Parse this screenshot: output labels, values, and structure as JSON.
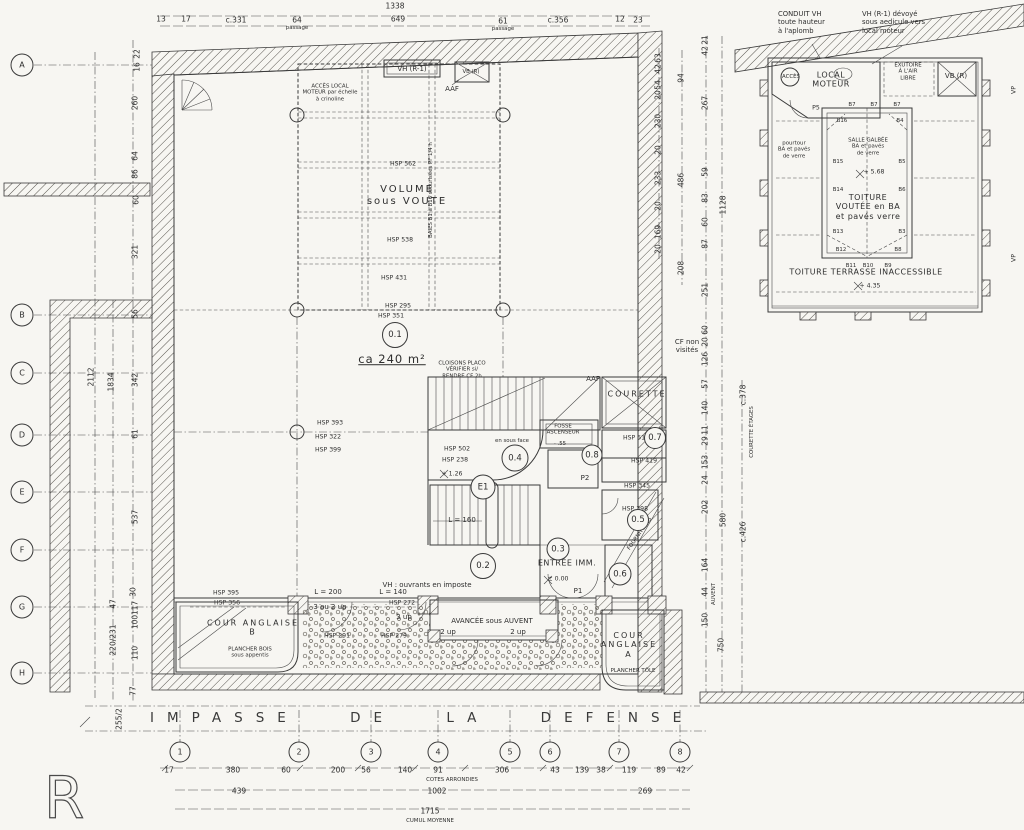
{
  "level_mark": "R",
  "street": {
    "name": "IMPASSE DE LA DEFENSE"
  },
  "grid_rows": [
    {
      "t": "A",
      "y": 65
    },
    {
      "t": "B",
      "y": 315
    },
    {
      "t": "C",
      "y": 373
    },
    {
      "t": "D",
      "y": 435
    },
    {
      "t": "E",
      "y": 492
    },
    {
      "t": "F",
      "y": 550
    },
    {
      "t": "G",
      "y": 607
    },
    {
      "t": "H",
      "y": 673
    }
  ],
  "grid_cols": [
    {
      "t": "1",
      "x": 180
    },
    {
      "t": "2",
      "x": 299
    },
    {
      "t": "3",
      "x": 371
    },
    {
      "t": "4",
      "x": 438
    },
    {
      "t": "5",
      "x": 510
    },
    {
      "t": "6",
      "x": 550
    },
    {
      "t": "7",
      "x": 619
    },
    {
      "t": "8",
      "x": 680
    }
  ],
  "rooms": [
    {
      "t": "0.1",
      "x": 395,
      "y": 335,
      "d": 24
    },
    {
      "t": "0.2",
      "x": 483,
      "y": 566,
      "d": 24
    },
    {
      "t": "0.3",
      "x": 558,
      "y": 549,
      "d": 21
    },
    {
      "t": "0.4",
      "x": 515,
      "y": 458,
      "d": 25
    },
    {
      "t": "0.5",
      "x": 638,
      "y": 520,
      "d": 20
    },
    {
      "t": "0.6",
      "x": 620,
      "y": 574,
      "d": 21
    },
    {
      "t": "0.7",
      "x": 655,
      "y": 438,
      "d": 20
    },
    {
      "t": "0.8",
      "x": 592,
      "y": 455,
      "d": 19
    },
    {
      "t": "E1",
      "x": 483,
      "y": 487,
      "d": 23
    }
  ],
  "annotations": [
    {
      "t": "CONDUIT VH\ntoute hauteur\nà l'aplomb",
      "x": 778,
      "y": 10,
      "c": "note",
      "n": "note-conduit-vh"
    },
    {
      "t": "VH (R-1) dévoyé\nsous aedicule vers\nlocal moteur",
      "x": 862,
      "y": 10,
      "c": "note",
      "n": "note-vh-devoye"
    },
    {
      "t": "1338",
      "x": 395,
      "y": 7,
      "c": "dim"
    },
    {
      "t": "13",
      "x": 161,
      "y": 20,
      "c": "dim"
    },
    {
      "t": "17",
      "x": 186,
      "y": 20,
      "c": "dim"
    },
    {
      "t": "c.331",
      "x": 236,
      "y": 21,
      "c": "dim"
    },
    {
      "t": "64",
      "x": 297,
      "y": 21,
      "c": "dim"
    },
    {
      "t": "passage",
      "x": 297,
      "y": 28,
      "c": "micro"
    },
    {
      "t": "649",
      "x": 398,
      "y": 20,
      "c": "dim"
    },
    {
      "t": "61",
      "x": 503,
      "y": 22,
      "c": "dim"
    },
    {
      "t": "passage",
      "x": 503,
      "y": 29,
      "c": "micro"
    },
    {
      "t": "c.356",
      "x": 558,
      "y": 21,
      "c": "dim"
    },
    {
      "t": "12",
      "x": 620,
      "y": 20,
      "c": "dim"
    },
    {
      "t": "23",
      "x": 638,
      "y": 21,
      "c": "dim"
    },
    {
      "t": "22",
      "x": 138,
      "y": 54,
      "r": -90,
      "c": "dim"
    },
    {
      "t": "16",
      "x": 138,
      "y": 67,
      "r": -90,
      "c": "dim"
    },
    {
      "t": "260",
      "x": 136,
      "y": 103,
      "r": -90,
      "c": "dim"
    },
    {
      "t": "64",
      "x": 136,
      "y": 156,
      "r": -90,
      "c": "dim"
    },
    {
      "t": "86",
      "x": 136,
      "y": 174,
      "r": -90,
      "c": "dim"
    },
    {
      "t": "60",
      "x": 137,
      "y": 200,
      "r": -90,
      "c": "dim"
    },
    {
      "t": "321",
      "x": 136,
      "y": 252,
      "r": -90,
      "c": "dim"
    },
    {
      "t": "56",
      "x": 136,
      "y": 314,
      "r": -90,
      "c": "dim"
    },
    {
      "t": "2112",
      "x": 92,
      "y": 377,
      "r": -90,
      "c": "dim"
    },
    {
      "t": "1834",
      "x": 112,
      "y": 382,
      "r": -90,
      "c": "dim"
    },
    {
      "t": "342",
      "x": 136,
      "y": 380,
      "r": -90,
      "c": "dim"
    },
    {
      "t": "61",
      "x": 136,
      "y": 434,
      "r": -90,
      "c": "dim"
    },
    {
      "t": "537",
      "x": 136,
      "y": 517,
      "r": -90,
      "c": "dim"
    },
    {
      "t": "30",
      "x": 134,
      "y": 592,
      "r": -90,
      "c": "dim"
    },
    {
      "t": "47",
      "x": 114,
      "y": 604,
      "r": -90,
      "c": "dim"
    },
    {
      "t": "117",
      "x": 136,
      "y": 608,
      "r": -90,
      "c": "dim"
    },
    {
      "t": "100",
      "x": 136,
      "y": 622,
      "r": -90,
      "c": "dim"
    },
    {
      "t": "220/231",
      "x": 114,
      "y": 640,
      "r": -90,
      "c": "dim"
    },
    {
      "t": "110",
      "x": 136,
      "y": 653,
      "r": -90,
      "c": "dim"
    },
    {
      "t": "77",
      "x": 134,
      "y": 691,
      "r": -90,
      "c": "dim"
    },
    {
      "t": "255/2",
      "x": 120,
      "y": 719,
      "r": -90,
      "c": "dim"
    },
    {
      "t": "63",
      "x": 659,
      "y": 58,
      "r": -90,
      "c": "dim"
    },
    {
      "t": "42",
      "x": 659,
      "y": 69,
      "r": -90,
      "c": "dim"
    },
    {
      "t": "54",
      "x": 659,
      "y": 85,
      "r": -90,
      "c": "dim"
    },
    {
      "t": "20",
      "x": 659,
      "y": 95,
      "r": -90,
      "c": "dim"
    },
    {
      "t": "230",
      "x": 659,
      "y": 121,
      "r": -90,
      "c": "dim"
    },
    {
      "t": "20",
      "x": 659,
      "y": 150,
      "r": -90,
      "c": "dim"
    },
    {
      "t": "233",
      "x": 659,
      "y": 178,
      "r": -90,
      "c": "dim"
    },
    {
      "t": "20",
      "x": 659,
      "y": 206,
      "r": -90,
      "c": "dim"
    },
    {
      "t": "169",
      "x": 659,
      "y": 232,
      "r": -90,
      "c": "dim"
    },
    {
      "t": "20",
      "x": 659,
      "y": 249,
      "r": -90,
      "c": "dim"
    },
    {
      "t": "94",
      "x": 682,
      "y": 78,
      "r": -90,
      "c": "dim"
    },
    {
      "t": "486",
      "x": 682,
      "y": 180,
      "r": -90,
      "c": "dim"
    },
    {
      "t": "208",
      "x": 682,
      "y": 268,
      "r": -90,
      "c": "dim"
    },
    {
      "t": "21",
      "x": 706,
      "y": 40,
      "r": -90,
      "c": "dim"
    },
    {
      "t": "42",
      "x": 706,
      "y": 51,
      "r": -90,
      "c": "dim"
    },
    {
      "t": "267",
      "x": 706,
      "y": 103,
      "r": -90,
      "c": "dim"
    },
    {
      "t": "59",
      "x": 706,
      "y": 172,
      "r": -90,
      "c": "dim"
    },
    {
      "t": "83",
      "x": 706,
      "y": 198,
      "r": -90,
      "c": "dim"
    },
    {
      "t": "60",
      "x": 706,
      "y": 222,
      "r": -90,
      "c": "dim"
    },
    {
      "t": "87",
      "x": 706,
      "y": 244,
      "r": -90,
      "c": "dim"
    },
    {
      "t": "251",
      "x": 706,
      "y": 290,
      "r": -90,
      "c": "dim"
    },
    {
      "t": "60",
      "x": 706,
      "y": 330,
      "r": -90,
      "c": "dim"
    },
    {
      "t": "20",
      "x": 706,
      "y": 342,
      "r": -90,
      "c": "dim"
    },
    {
      "t": "126",
      "x": 706,
      "y": 359,
      "r": -90,
      "c": "dim"
    },
    {
      "t": "57",
      "x": 706,
      "y": 384,
      "r": -90,
      "c": "dim"
    },
    {
      "t": "140",
      "x": 706,
      "y": 408,
      "r": -90,
      "c": "dim"
    },
    {
      "t": "11",
      "x": 706,
      "y": 430,
      "r": -90,
      "c": "dim"
    },
    {
      "t": "29",
      "x": 706,
      "y": 441,
      "r": -90,
      "c": "dim"
    },
    {
      "t": "153",
      "x": 706,
      "y": 462,
      "r": -90,
      "c": "dim"
    },
    {
      "t": "24",
      "x": 706,
      "y": 480,
      "r": -90,
      "c": "dim"
    },
    {
      "t": "202",
      "x": 706,
      "y": 507,
      "r": -90,
      "c": "dim"
    },
    {
      "t": "164",
      "x": 706,
      "y": 565,
      "r": -90,
      "c": "dim"
    },
    {
      "t": "44",
      "x": 706,
      "y": 592,
      "r": -90,
      "c": "dim"
    },
    {
      "t": "AUVENT",
      "x": 714,
      "y": 594,
      "r": -90,
      "c": "micro"
    },
    {
      "t": "150",
      "x": 706,
      "y": 620,
      "r": -90,
      "c": "dim"
    },
    {
      "t": "1128",
      "x": 724,
      "y": 205,
      "r": -90,
      "c": "dim"
    },
    {
      "t": "580",
      "x": 724,
      "y": 520,
      "r": -90,
      "c": "dim"
    },
    {
      "t": "c.378",
      "x": 744,
      "y": 395,
      "r": -90,
      "c": "dim"
    },
    {
      "t": "COURETTE ÉTAGES",
      "x": 752,
      "y": 432,
      "r": -90,
      "c": "micro"
    },
    {
      "t": "c.426",
      "x": 744,
      "y": 532,
      "r": -90,
      "c": "dim"
    },
    {
      "t": "750",
      "x": 722,
      "y": 645,
      "r": -90,
      "c": "dim"
    },
    {
      "t": "VP",
      "x": 1014,
      "y": 90,
      "r": -90,
      "c": "tiny"
    },
    {
      "t": "VP",
      "x": 1014,
      "y": 258,
      "r": -90,
      "c": "tiny"
    },
    {
      "t": "ACCÈS",
      "x": 791,
      "y": 77,
      "c": "micro"
    },
    {
      "t": "LOCAL\nMOTEUR",
      "x": 831,
      "y": 80,
      "c": "med"
    },
    {
      "t": "EXUTOIRE\nÀ L'AIR\nLIBRE",
      "x": 908,
      "y": 72,
      "c": "micro"
    },
    {
      "t": "VB (R)",
      "x": 956,
      "y": 76,
      "c": "small"
    },
    {
      "t": "P5",
      "x": 816,
      "y": 108,
      "c": "tiny"
    },
    {
      "t": "B7",
      "x": 852,
      "y": 105,
      "c": "micro"
    },
    {
      "t": "B7",
      "x": 874,
      "y": 105,
      "c": "micro"
    },
    {
      "t": "B7",
      "x": 897,
      "y": 105,
      "c": "micro"
    },
    {
      "t": "B16",
      "x": 842,
      "y": 121,
      "c": "micro"
    },
    {
      "t": "B4",
      "x": 900,
      "y": 121,
      "c": "micro"
    },
    {
      "t": "pourtour\nBA et pavés\nde verre",
      "x": 794,
      "y": 150,
      "c": "micro"
    },
    {
      "t": "SALLE GALBÉE\nBA et pavés\nde verre",
      "x": 868,
      "y": 147,
      "c": "micro"
    },
    {
      "t": "B15",
      "x": 838,
      "y": 162,
      "c": "micro"
    },
    {
      "t": "B5",
      "x": 902,
      "y": 162,
      "c": "micro"
    },
    {
      "t": "+ 5.68",
      "x": 874,
      "y": 172,
      "c": "tiny"
    },
    {
      "t": "B14",
      "x": 838,
      "y": 190,
      "c": "micro"
    },
    {
      "t": "B6",
      "x": 902,
      "y": 190,
      "c": "micro"
    },
    {
      "t": "TOITURE\nVOUTÉE en BA\net pavés verre",
      "x": 868,
      "y": 207,
      "c": "med"
    },
    {
      "t": "B13",
      "x": 838,
      "y": 232,
      "c": "micro"
    },
    {
      "t": "B3",
      "x": 902,
      "y": 232,
      "c": "micro"
    },
    {
      "t": "B12",
      "x": 841,
      "y": 250,
      "c": "micro"
    },
    {
      "t": "B8",
      "x": 898,
      "y": 250,
      "c": "micro"
    },
    {
      "t": "B11",
      "x": 851,
      "y": 266,
      "c": "micro"
    },
    {
      "t": "B10",
      "x": 868,
      "y": 266,
      "c": "micro"
    },
    {
      "t": "B9",
      "x": 888,
      "y": 266,
      "c": "micro"
    },
    {
      "t": "TOITURE  TERRASSE  INACCESSIBLE",
      "x": 866,
      "y": 272,
      "c": "med"
    },
    {
      "t": "+ 4.35",
      "x": 870,
      "y": 286,
      "c": "tiny"
    },
    {
      "t": "VH (R-1)",
      "x": 412,
      "y": 69,
      "c": "small"
    },
    {
      "t": "VB (R)",
      "x": 471,
      "y": 72,
      "c": "micro"
    },
    {
      "t": "AAF",
      "x": 452,
      "y": 89,
      "c": "small"
    },
    {
      "t": "ACCÈS LOCAL\nMOTEUR par échelle\nà crinoline",
      "x": 330,
      "y": 93,
      "c": "micro"
    },
    {
      "t": "HSP 562",
      "x": 403,
      "y": 164,
      "c": "tiny"
    },
    {
      "t": "VOLUME\nsous VOUTE",
      "x": 407,
      "y": 196,
      "c": "big"
    },
    {
      "t": "BAIES B1 à B16 sécurisées PF 1/4 h",
      "x": 431,
      "y": 190,
      "r": -90,
      "c": "micro"
    },
    {
      "t": "HSP 538",
      "x": 400,
      "y": 240,
      "c": "tiny"
    },
    {
      "t": "HSP 431",
      "x": 394,
      "y": 278,
      "c": "tiny"
    },
    {
      "t": "HSP 295",
      "x": 398,
      "y": 306,
      "c": "tiny"
    },
    {
      "t": "HSP 351",
      "x": 391,
      "y": 316,
      "c": "tiny"
    },
    {
      "t": "ca 240 m²",
      "x": 392,
      "y": 360,
      "c": "area",
      "n": "area-label"
    },
    {
      "t": "CLOISONS PLACO\nVÉRIFIER si/\nRENDRE CF 2h",
      "x": 462,
      "y": 370,
      "c": "micro"
    },
    {
      "t": "AAF",
      "x": 593,
      "y": 379,
      "c": "small"
    },
    {
      "t": "COURETTE",
      "x": 637,
      "y": 394,
      "c": "med ls2"
    },
    {
      "t": "HSP 393",
      "x": 330,
      "y": 423,
      "c": "tiny"
    },
    {
      "t": "HSP 322",
      "x": 328,
      "y": 437,
      "c": "tiny"
    },
    {
      "t": "HSP 399",
      "x": 328,
      "y": 450,
      "c": "tiny"
    },
    {
      "t": "FOSSE\nASCENSEUR",
      "x": 563,
      "y": 430,
      "c": "micro"
    },
    {
      "t": "- .55",
      "x": 560,
      "y": 444,
      "c": "micro"
    },
    {
      "t": "en sous face",
      "x": 512,
      "y": 441,
      "c": "micro"
    },
    {
      "t": "HSP 502",
      "x": 457,
      "y": 449,
      "c": "tiny"
    },
    {
      "t": "HSP 238",
      "x": 455,
      "y": 460,
      "c": "tiny"
    },
    {
      "t": "+ 1.26",
      "x": 452,
      "y": 474,
      "c": "tiny"
    },
    {
      "t": "HSP 518",
      "x": 636,
      "y": 438,
      "c": "tiny"
    },
    {
      "t": "HSP 419",
      "x": 644,
      "y": 461,
      "c": "tiny"
    },
    {
      "t": "HSP 345",
      "x": 637,
      "y": 486,
      "c": "tiny"
    },
    {
      "t": "HSP 398",
      "x": 635,
      "y": 509,
      "c": "tiny"
    },
    {
      "t": "P2",
      "x": 585,
      "y": 478,
      "c": "small"
    },
    {
      "t": "L = 160",
      "x": 462,
      "y": 520,
      "c": "small"
    },
    {
      "t": "FOURNITURES",
      "x": 640,
      "y": 534,
      "r": -55,
      "c": "micro"
    },
    {
      "t": "ENTRÉE IMM.",
      "x": 567,
      "y": 563,
      "c": "med"
    },
    {
      "t": "± 0.00",
      "x": 558,
      "y": 579,
      "c": "tiny"
    },
    {
      "t": "P1",
      "x": 578,
      "y": 591,
      "c": "small"
    },
    {
      "t": "VH : ouvrants en imposte",
      "x": 427,
      "y": 585,
      "c": "small"
    },
    {
      "t": "L = 200",
      "x": 328,
      "y": 592,
      "c": "small"
    },
    {
      "t": "L = 140",
      "x": 393,
      "y": 592,
      "c": "small"
    },
    {
      "t": "HSP 395",
      "x": 226,
      "y": 593,
      "c": "tiny"
    },
    {
      "t": "HSP 356",
      "x": 227,
      "y": 603,
      "c": "tiny"
    },
    {
      "t": "3 ou 2 up",
      "x": 330,
      "y": 607,
      "c": "small"
    },
    {
      "t": "HSP 272",
      "x": 402,
      "y": 603,
      "c": "tiny"
    },
    {
      "t": "3 up",
      "x": 404,
      "y": 617,
      "c": "small"
    },
    {
      "t": "HSP 291",
      "x": 337,
      "y": 636,
      "c": "tiny"
    },
    {
      "t": "HSP 279",
      "x": 394,
      "y": 636,
      "c": "tiny"
    },
    {
      "t": "COUR  ANGLAISE\nB",
      "x": 253,
      "y": 628,
      "c": "med ls2"
    },
    {
      "t": "PLANCHER BOIS\nsous appentis",
      "x": 250,
      "y": 653,
      "c": "micro"
    },
    {
      "t": "AVANCÉE sous AUVENT",
      "x": 492,
      "y": 621,
      "c": "small"
    },
    {
      "t": "2 up",
      "x": 448,
      "y": 632,
      "c": "small"
    },
    {
      "t": "2 up",
      "x": 518,
      "y": 632,
      "c": "small"
    },
    {
      "t": "COUR\nANGLAISE\nA",
      "x": 629,
      "y": 645,
      "c": "med ls2"
    },
    {
      "t": "PLANCHER TÔLE",
      "x": 633,
      "y": 671,
      "c": "micro"
    },
    {
      "t": "CF non\nvisités",
      "x": 687,
      "y": 346,
      "c": "small"
    },
    {
      "t": "17",
      "x": 169,
      "y": 771,
      "c": "dim"
    },
    {
      "t": "380",
      "x": 233,
      "y": 771,
      "c": "dim"
    },
    {
      "t": "60",
      "x": 286,
      "y": 771,
      "c": "dim"
    },
    {
      "t": "200",
      "x": 338,
      "y": 771,
      "c": "dim"
    },
    {
      "t": "56",
      "x": 366,
      "y": 771,
      "c": "dim"
    },
    {
      "t": "140",
      "x": 405,
      "y": 771,
      "c": "dim"
    },
    {
      "t": "91",
      "x": 438,
      "y": 771,
      "c": "dim"
    },
    {
      "t": "306",
      "x": 502,
      "y": 771,
      "c": "dim"
    },
    {
      "t": "43",
      "x": 555,
      "y": 771,
      "c": "dim"
    },
    {
      "t": "139",
      "x": 582,
      "y": 771,
      "c": "dim"
    },
    {
      "t": "38",
      "x": 601,
      "y": 771,
      "c": "dim"
    },
    {
      "t": "119",
      "x": 629,
      "y": 771,
      "c": "dim"
    },
    {
      "t": "89",
      "x": 661,
      "y": 771,
      "c": "dim"
    },
    {
      "t": "42",
      "x": 681,
      "y": 771,
      "c": "dim"
    },
    {
      "t": "COTES ARRONDIES",
      "x": 452,
      "y": 780,
      "c": "micro"
    },
    {
      "t": "439",
      "x": 239,
      "y": 792,
      "c": "dim"
    },
    {
      "t": "1002",
      "x": 437,
      "y": 792,
      "c": "dim"
    },
    {
      "t": "269",
      "x": 645,
      "y": 792,
      "c": "dim"
    },
    {
      "t": "1715",
      "x": 430,
      "y": 812,
      "c": "dim"
    },
    {
      "t": "CUMUL MOYENNE",
      "x": 430,
      "y": 821,
      "c": "micro"
    }
  ]
}
